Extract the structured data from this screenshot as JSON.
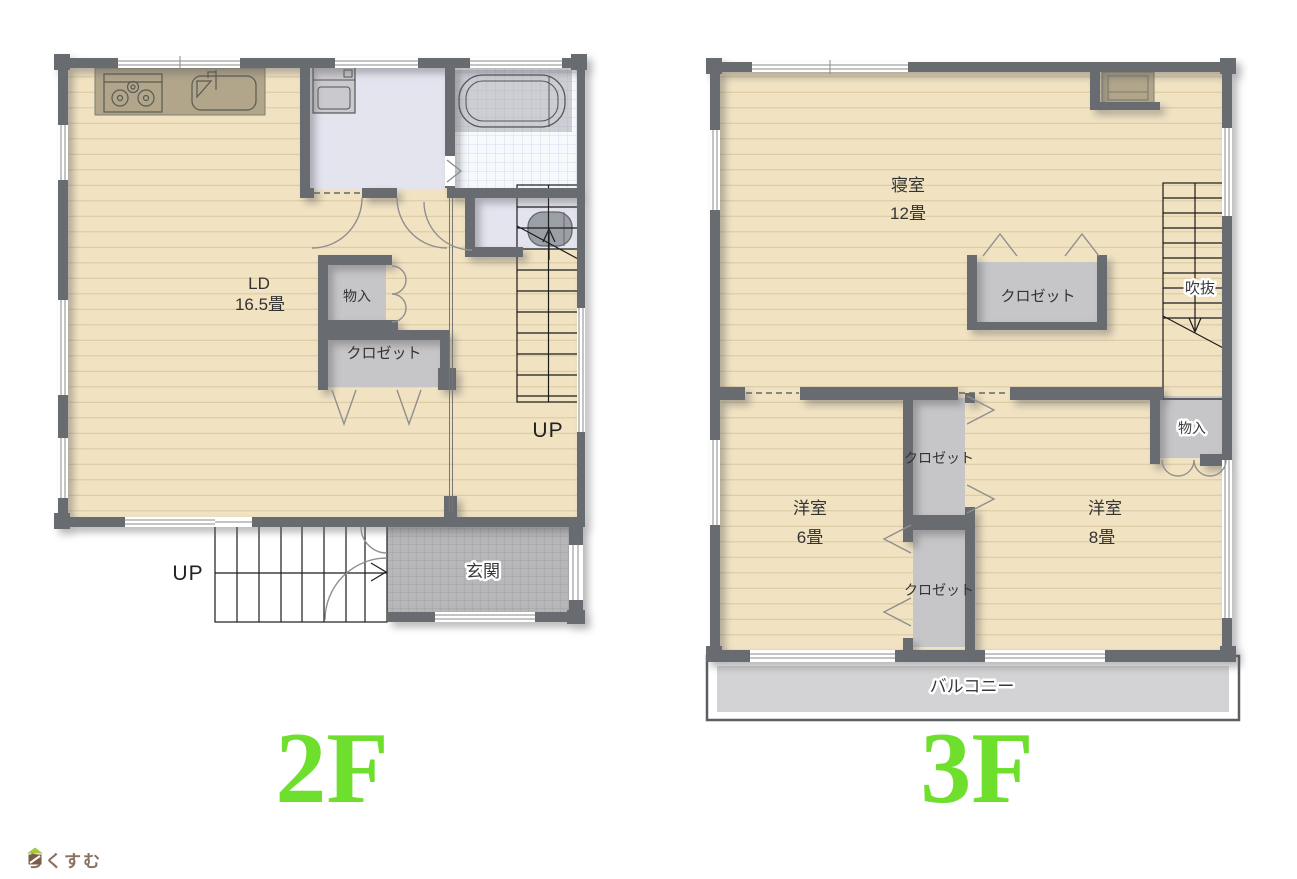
{
  "branding": {
    "logo_text": "らくすむ"
  },
  "floor2": {
    "label": "2F",
    "up_inner": "UP",
    "up_outer": "UP",
    "rooms": {
      "ld": {
        "name": "LD",
        "size": "16.5畳"
      },
      "storage": {
        "name": "物入"
      },
      "closet": {
        "name": "クロゼット"
      },
      "genkan": {
        "name": "玄関"
      }
    }
  },
  "floor3": {
    "label": "3F",
    "rooms": {
      "bedroom": {
        "name": "寝室",
        "size": "12畳"
      },
      "bedroom_closet": {
        "name": "クロゼット"
      },
      "void": {
        "name": "吹抜"
      },
      "storage": {
        "name": "物入"
      },
      "closet_a": {
        "name": "クロゼット"
      },
      "closet_b": {
        "name": "クロゼット"
      },
      "west6": {
        "name": "洋室",
        "size": "6畳"
      },
      "west8": {
        "name": "洋室",
        "size": "8畳"
      },
      "balcony": {
        "name": "バルコニー"
      }
    }
  },
  "colors": {
    "wall": "#686b6f",
    "floor_wood": "#f1e3c2",
    "closet_fill": "#c6c6c8",
    "lavender": "#e4e4ef",
    "tile_gray": "#b7b7b9",
    "balcony_gray": "#d3d3d5",
    "accent_green": "#6fdf2e",
    "logo_brown": "#8a7161"
  }
}
